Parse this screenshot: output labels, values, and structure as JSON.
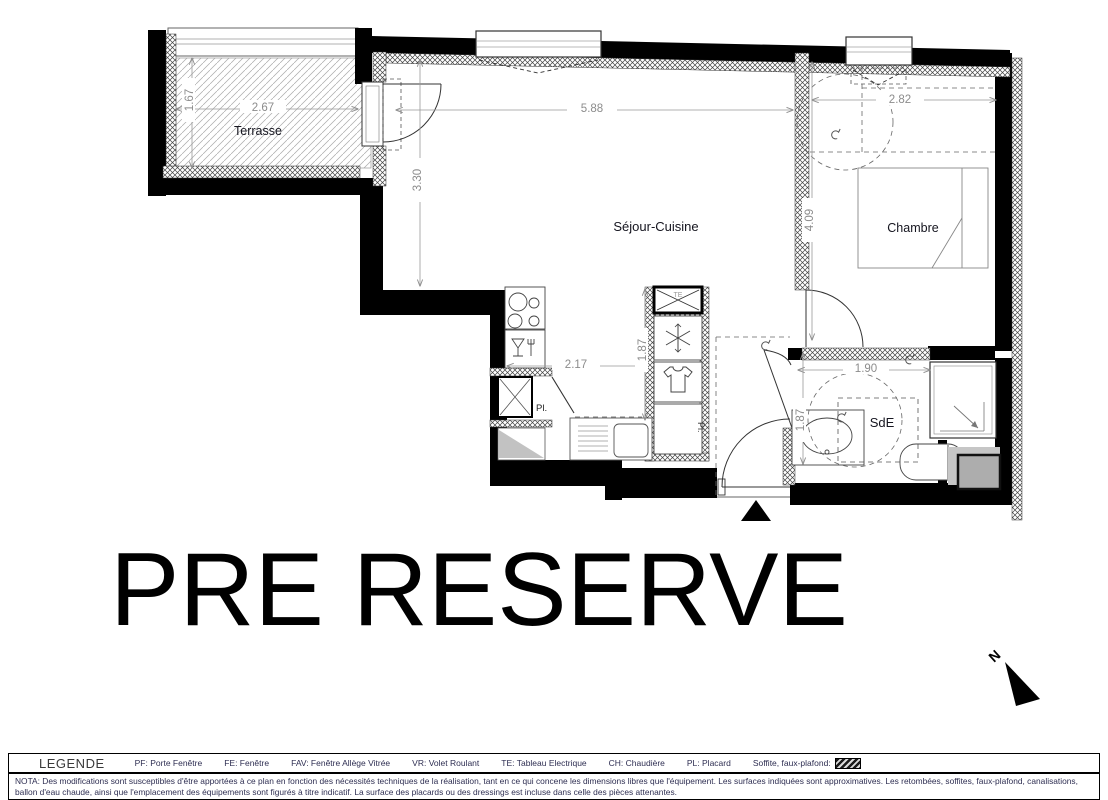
{
  "plan": {
    "rooms": {
      "terrasse": "Terrasse",
      "sejour_cuisine": "Séjour-Cuisine",
      "chambre": "Chambre",
      "sde": "SdE"
    },
    "annotations": {
      "placard_abbrev": "Pl.",
      "te_abbrev": "TE"
    },
    "dimensions": {
      "terrasse_depth": "1.67",
      "terrasse_width": "2.67",
      "sejour_width": "5.88",
      "sejour_depth": "3.30",
      "chambre_width": "2.82",
      "chambre_depth": "4.09",
      "cuisine_width": "2.17",
      "cuisine_depth": "1.87",
      "sde_width": "1.90",
      "sde_depth": "1.87"
    },
    "north_label": "N"
  },
  "watermark": "PRE RESERVE",
  "legend": {
    "title": "LEGENDE",
    "items": [
      "PF: Porte Fenêtre",
      "FE: Fenêtre",
      "FAV: Fenêtre Allège Vitrée",
      "VR: Volet Roulant",
      "TE: Tableau Electrique",
      "CH: Chaudière",
      "PL: Placard"
    ],
    "soffite_label": "Soffite, faux-plafond:"
  },
  "nota": "NOTA: Des modifications sont susceptibles d'être apportées à ce plan en fonction des nécessités techniques de la réalisation, tant en ce qui concene les dimensions libres que l'équipement. Les surfaces indiquées sont approximatives. Les retombées, soffites, faux-plafond, canalisations, ballon d'eau chaude, ainsi que l'emplacement des équipements sont figurés à titre indicatif. La surface des placards ou des dressings est incluse dans celle des pièces attenantes.",
  "colors": {
    "wall": "#000000",
    "dimension_text": "#8c8c8c",
    "legend_text": "#2e2e52",
    "watermark_text": "#000000"
  }
}
